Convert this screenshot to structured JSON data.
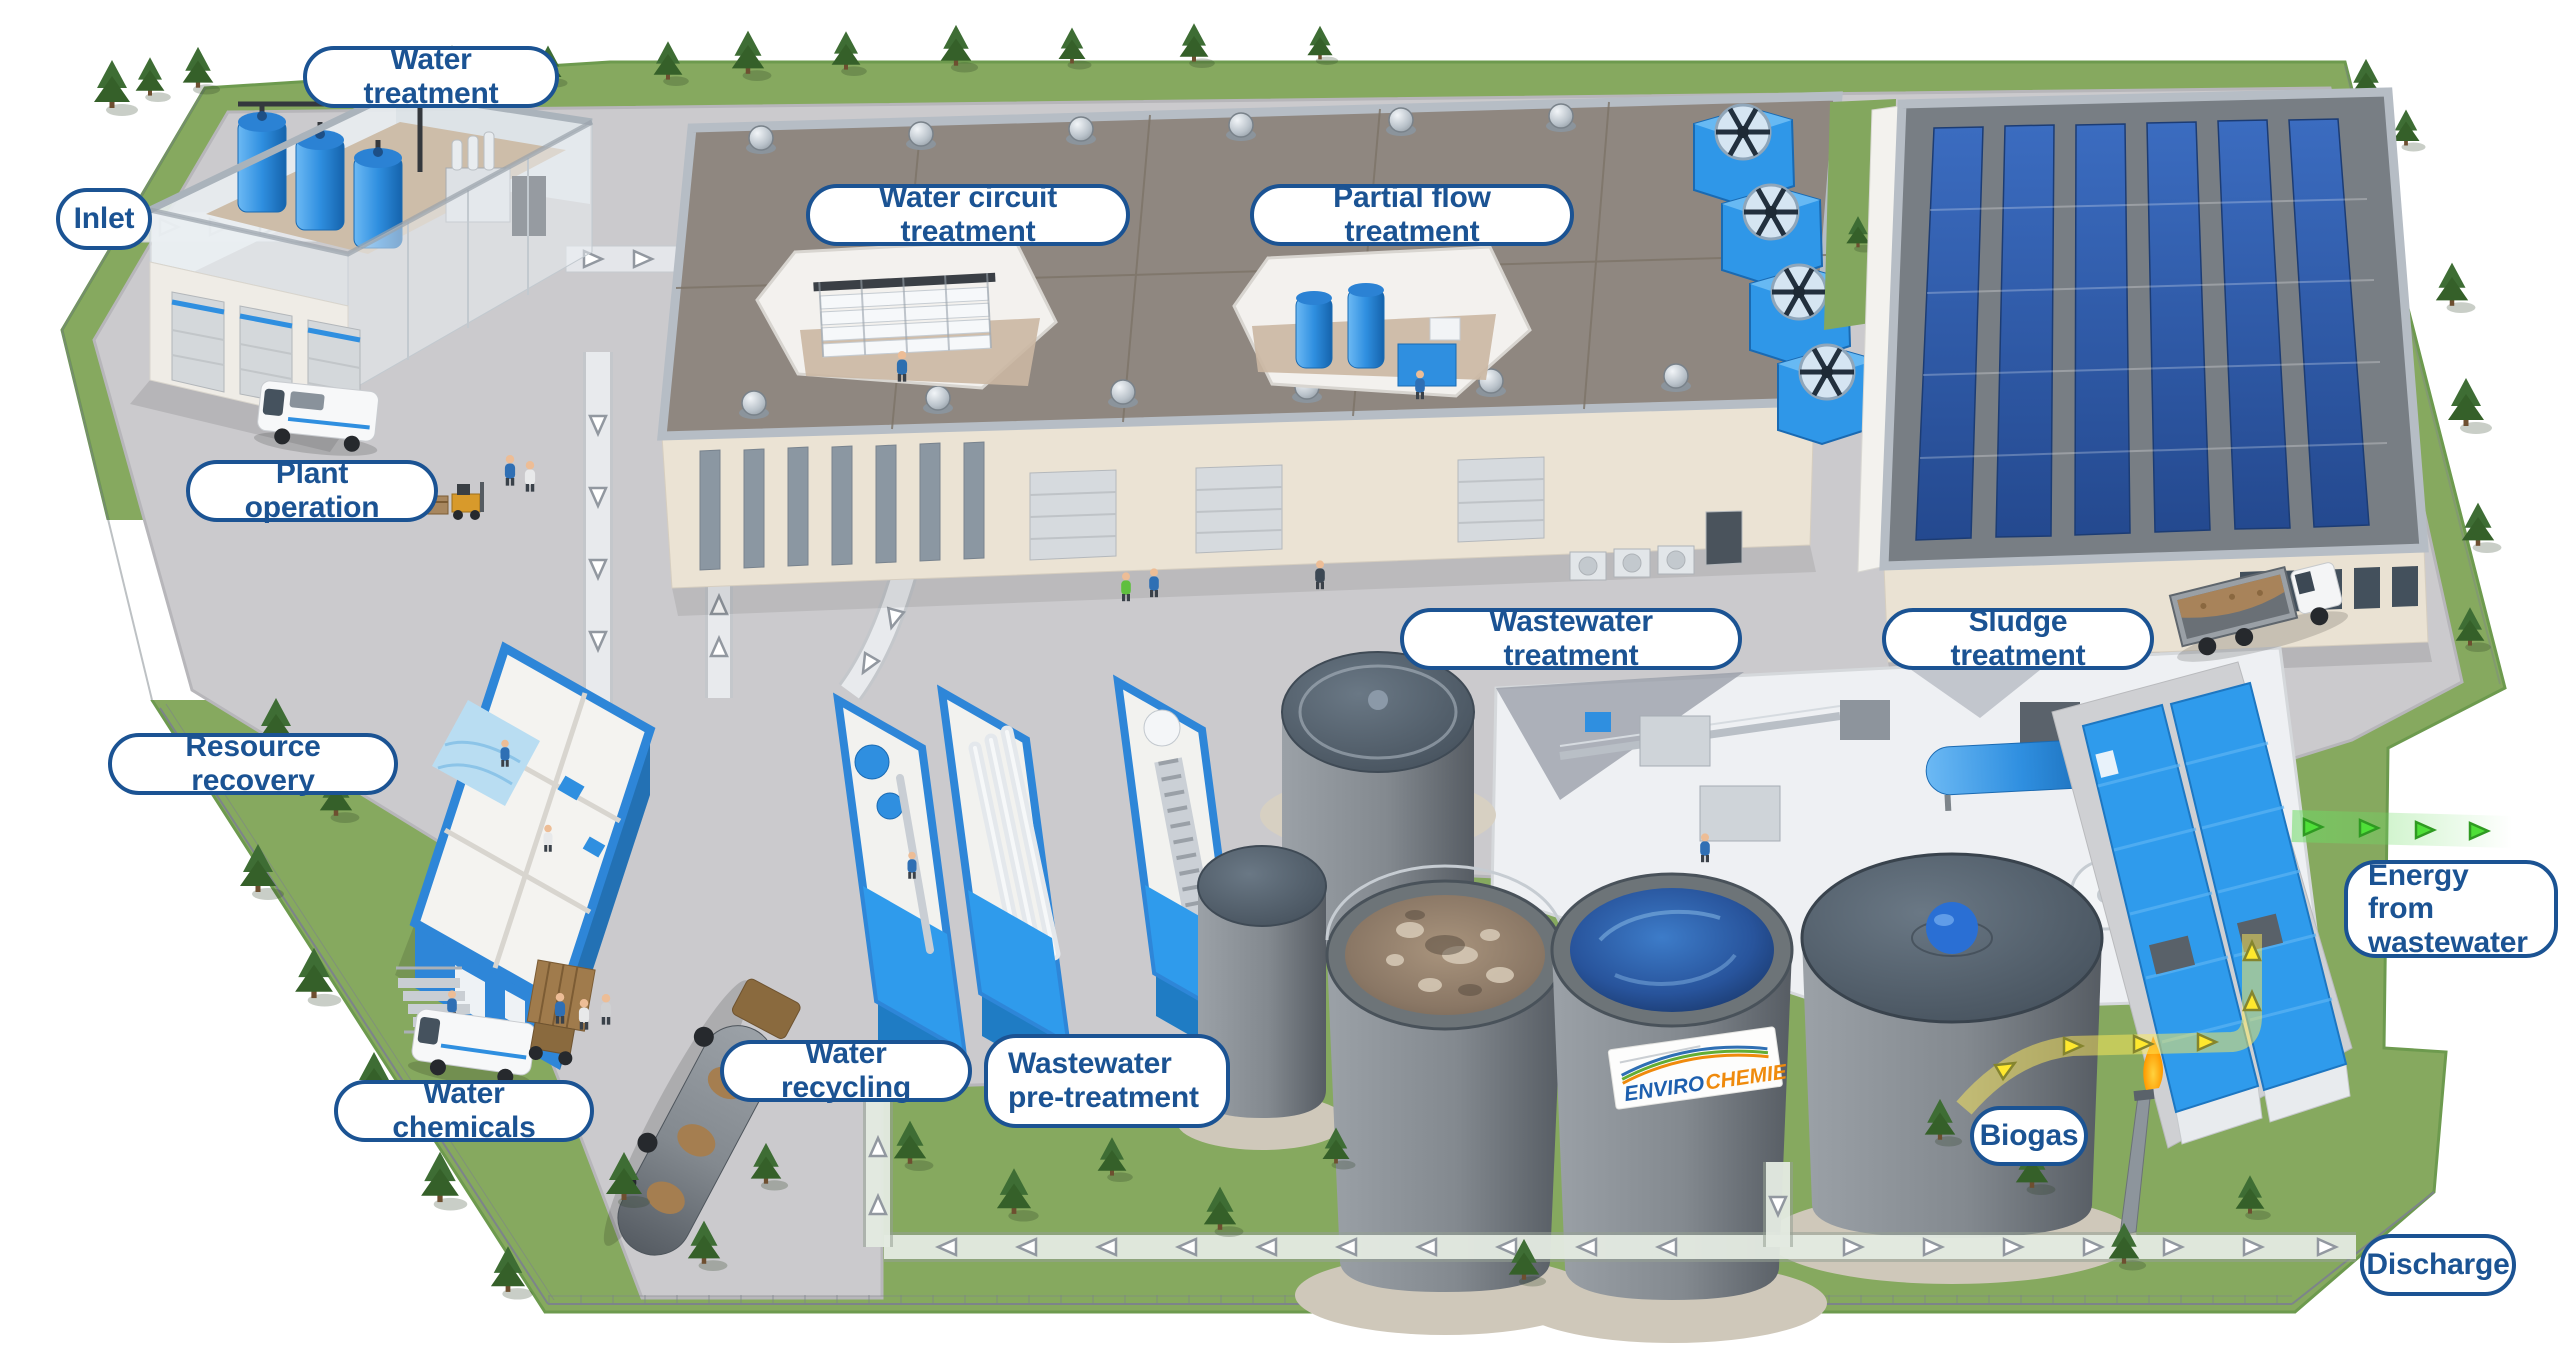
{
  "labels": {
    "water_treatment": "Water treatment",
    "inlet": "Inlet",
    "water_circuit_treatment": "Water circuit treatment",
    "partial_flow_treatment": "Partial flow treatment",
    "plant_operation": "Plant operation",
    "resource_recovery": "Resource recovery",
    "wastewater_treatment": "Wastewater treatment",
    "sludge_treatment": "Sludge treatment",
    "water_chemicals": "Water chemicals",
    "water_recycling": "Water recycling",
    "wastewater_pre_treatment": "Wastewater pre-treatment",
    "biogas": "Biogas",
    "energy_from_wastewater": "Energy from wastewater",
    "discharge": "Discharge"
  },
  "branding": {
    "tank_banner_enviro": "ENVIRO",
    "tank_banner_chemie": "CHEMIE"
  },
  "colors": {
    "label_border": "#1b5393",
    "label_text": "#1b5393",
    "label_background": "#ffffff",
    "equipment_blue": "#2f97e8",
    "container_blue": "#2f9bec",
    "grass_green": "#86a95f",
    "pavement_gray": "#cbcacd",
    "roof_taupe": "#8f8780",
    "solar_panel_blue": "#2e5fb2",
    "tank_gray": "#83898f",
    "water_blue": "#28549c",
    "biogas_arrow_yellow": "#ffe82e",
    "energy_arrow_green": "#4fdf38",
    "flow_arrow_white": "#ffffff",
    "flare_flame_orange": "#ff9a00"
  }
}
